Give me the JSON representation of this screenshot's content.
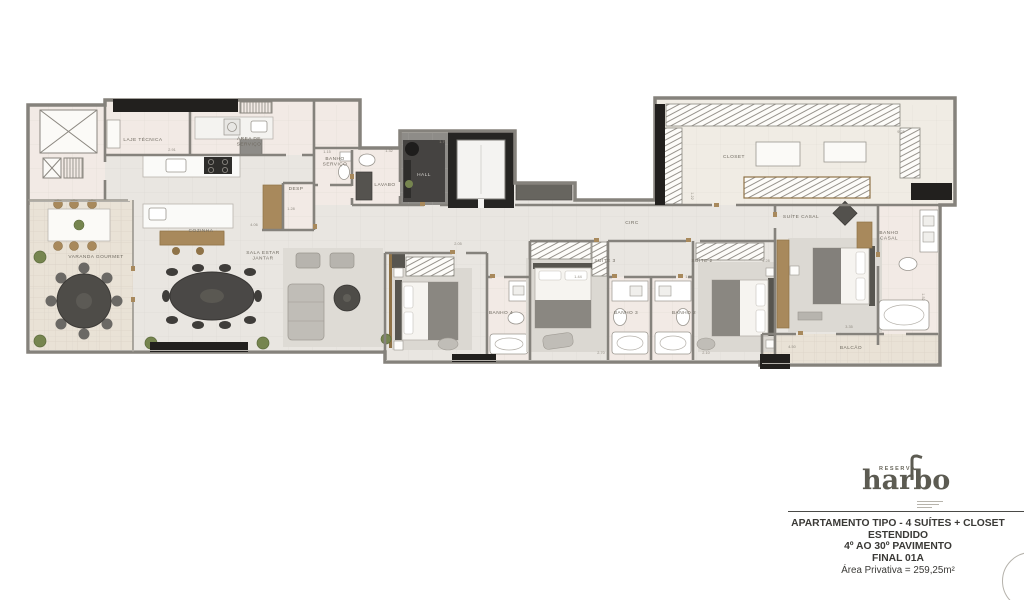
{
  "branding": {
    "reserva": "RESERVA",
    "name": "harbo"
  },
  "title_block": {
    "lines": [
      "APARTAMENTO TIPO - 4 SUÍTES + CLOSET",
      "ESTENDIDO",
      "4º AO 30º PAVIMENTO",
      "FINAL 01A"
    ],
    "area_line": "Área Privativa = 259,25m²"
  },
  "colors": {
    "wall": "#85827c",
    "black_structure": "#22201e",
    "wood": "#a8895c",
    "floor_main": "#e9e6e1",
    "floor_service": "#f2eae5",
    "floor_outdoor": "#e9e2d6",
    "dark_furniture": "#53514d",
    "plant_green": "#76854f",
    "label": "#6f6a60",
    "logo": "#5c5b52"
  },
  "plan": {
    "rooms": [
      {
        "id": "laje-tecnica",
        "lines": [
          "LAJE TÉCNICA"
        ],
        "x": 143,
        "y": 141
      },
      {
        "id": "area-servico",
        "lines": [
          "ÁREA DE",
          "SERVIÇO"
        ],
        "x": 249,
        "y": 140
      },
      {
        "id": "banho-servico",
        "lines": [
          "BANHO",
          "SERVIÇO"
        ],
        "x": 335,
        "y": 160
      },
      {
        "id": "cozinha",
        "lines": [
          "COZINHA"
        ],
        "x": 201,
        "y": 232
      },
      {
        "id": "desp",
        "lines": [
          "DESP"
        ],
        "x": 296,
        "y": 190,
        "fs": 4.2
      },
      {
        "id": "lavabo",
        "lines": [
          "LAVABO"
        ],
        "x": 385,
        "y": 186
      },
      {
        "id": "hall",
        "lines": [
          "HALL"
        ],
        "x": 424,
        "y": 176,
        "cls": "light"
      },
      {
        "id": "varanda-gourmet",
        "lines": [
          "VARANDA GOURMET"
        ],
        "x": 96,
        "y": 258
      },
      {
        "id": "sala-estar-jantar",
        "lines": [
          "SALA ESTAR",
          "JANTAR"
        ],
        "x": 263,
        "y": 254
      },
      {
        "id": "circ",
        "lines": [
          "CIRC"
        ],
        "x": 632,
        "y": 224
      },
      {
        "id": "suite-3",
        "lines": [
          "SUÍTE 3"
        ],
        "x": 605,
        "y": 262
      },
      {
        "id": "suite-2",
        "lines": [
          "SUÍTE 2"
        ],
        "x": 702,
        "y": 262
      },
      {
        "id": "banho-4",
        "lines": [
          "BANHO 4"
        ],
        "x": 501,
        "y": 314,
        "fs": 4.2
      },
      {
        "id": "banho-3",
        "lines": [
          "BANHO 3"
        ],
        "x": 626,
        "y": 314,
        "fs": 4.2
      },
      {
        "id": "banho-2",
        "lines": [
          "BANHO 2"
        ],
        "x": 684,
        "y": 314,
        "fs": 4.2
      },
      {
        "id": "closet",
        "lines": [
          "CLOSET"
        ],
        "x": 734,
        "y": 158
      },
      {
        "id": "suite-casal",
        "lines": [
          "SUÍTE CASAL"
        ],
        "x": 801,
        "y": 218
      },
      {
        "id": "banho-casal",
        "lines": [
          "BANHO",
          "CASAL"
        ],
        "x": 889,
        "y": 234,
        "fs": 4.2
      },
      {
        "id": "balcao",
        "lines": [
          "BALCÃO"
        ],
        "x": 851,
        "y": 349
      }
    ],
    "dimensions": [
      {
        "t": "2.91",
        "x": 172,
        "y": 151
      },
      {
        "t": "4.06",
        "x": 254,
        "y": 226
      },
      {
        "t": "1.28",
        "x": 291,
        "y": 210
      },
      {
        "t": "1.15",
        "x": 327,
        "y": 153
      },
      {
        "t": "1.32",
        "x": 389,
        "y": 152
      },
      {
        "t": "1.79",
        "x": 443,
        "y": 143
      },
      {
        "t": "2.05",
        "x": 458,
        "y": 245
      },
      {
        "t": "1.44",
        "x": 578,
        "y": 278
      },
      {
        "t": "1.60",
        "x": 689,
        "y": 278
      },
      {
        "t": "2.70",
        "x": 601,
        "y": 354
      },
      {
        "t": "2.10",
        "x": 706,
        "y": 354
      },
      {
        "t": "9.25",
        "x": 901,
        "y": 133
      },
      {
        "t": "4.28",
        "x": 766,
        "y": 262
      },
      {
        "t": "1.22",
        "x": 691,
        "y": 196,
        "r": 90
      },
      {
        "t": "1.52",
        "x": 922,
        "y": 297,
        "r": 90
      },
      {
        "t": "4.50",
        "x": 792,
        "y": 348
      },
      {
        "t": "3.35",
        "x": 849,
        "y": 328
      }
    ]
  }
}
